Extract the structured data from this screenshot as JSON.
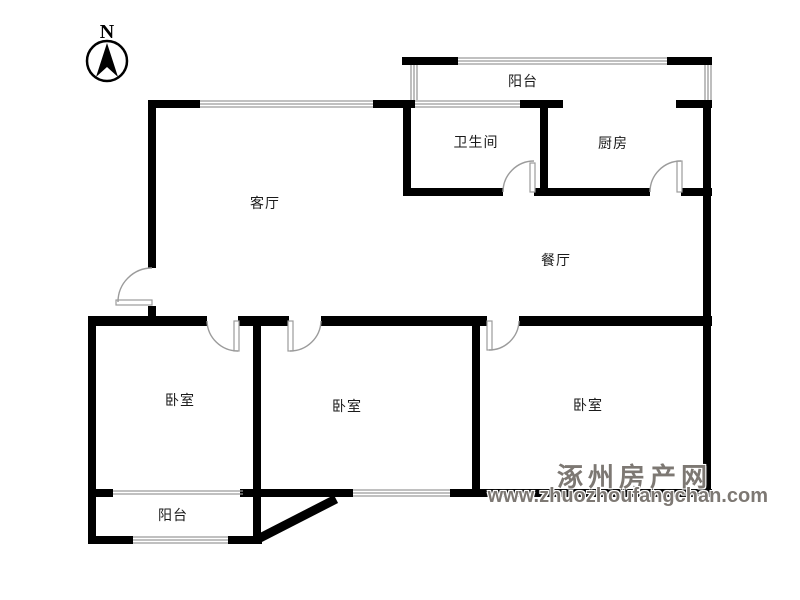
{
  "compass": {
    "label": "N"
  },
  "rooms": [
    {
      "id": "balcony-top",
      "label": "阳台"
    },
    {
      "id": "bathroom",
      "label": "卫生间"
    },
    {
      "id": "kitchen",
      "label": "厨房"
    },
    {
      "id": "living-room",
      "label": "客厅"
    },
    {
      "id": "dining-room",
      "label": "餐厅"
    },
    {
      "id": "bedroom-left",
      "label": "卧室"
    },
    {
      "id": "bedroom-middle",
      "label": "卧室"
    },
    {
      "id": "bedroom-right",
      "label": "卧室"
    },
    {
      "id": "balcony-bottom",
      "label": "阳台"
    }
  ],
  "watermark": {
    "site_name": "涿州房产网",
    "site_url": "www.zhuozhoufangchan.com"
  },
  "colors": {
    "background": "#ffffff",
    "wall": "#000000",
    "window_line": "#9b9b9b",
    "door_line": "#9b9b9b",
    "room_label": "#1a1a1a",
    "watermark": "#7d7873"
  }
}
